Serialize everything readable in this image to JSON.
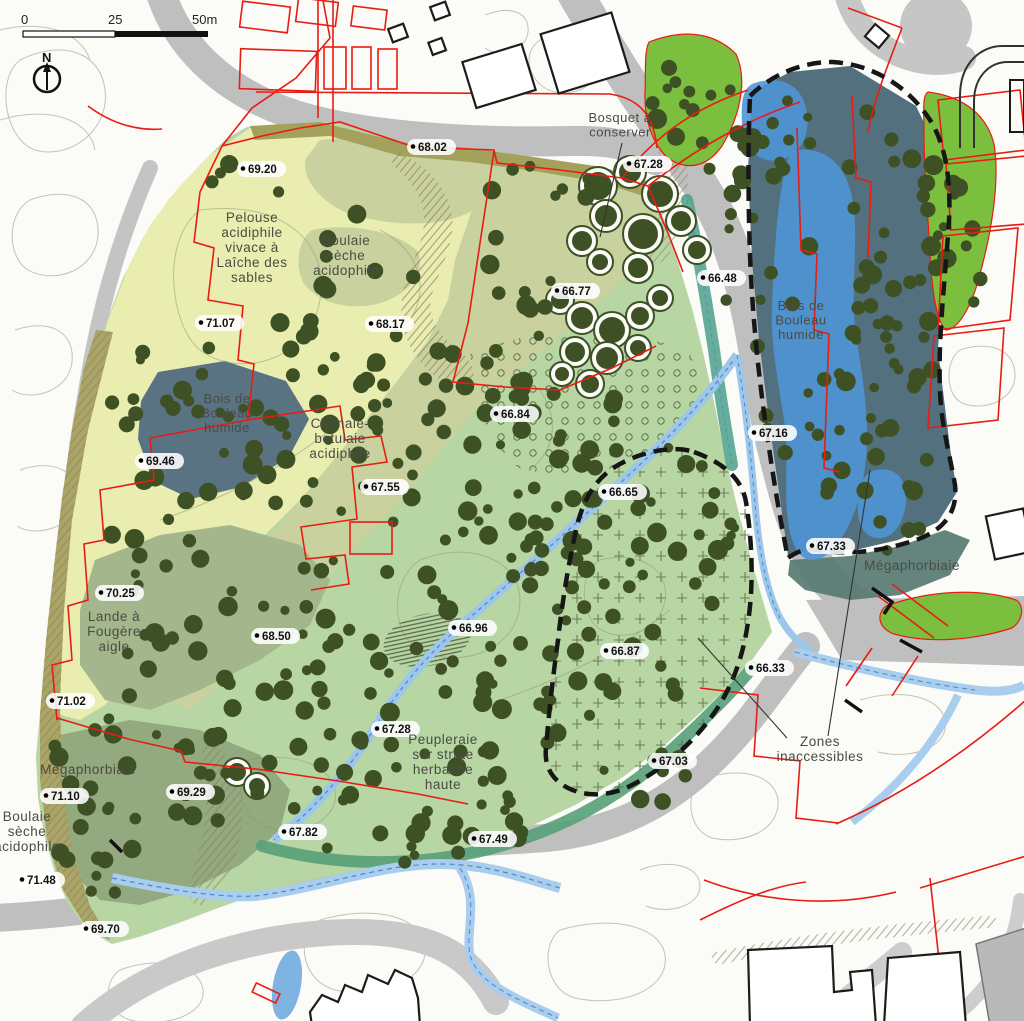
{
  "map": {
    "scale_bar": {
      "tick_0": "0",
      "tick_25": "25",
      "tick_50": "50m"
    },
    "north_arrow": {
      "label": "N"
    },
    "zone_labels": [
      {
        "name": "pelouse-acidiphile",
        "lines": [
          "Pelouse",
          "acidiphile",
          "vivace à",
          "Laîche des",
          "sables"
        ],
        "x": 252,
        "y": 222,
        "size": 13.5
      },
      {
        "name": "boulaie-seche-nord",
        "lines": [
          "Boulaie",
          "sèche",
          "acidophile"
        ],
        "x": 346,
        "y": 245,
        "size": 13.5
      },
      {
        "name": "chenaie-betulaie",
        "lines": [
          "Chênaie-",
          "betulaie",
          "acidiphile"
        ],
        "x": 340,
        "y": 428,
        "size": 13.5
      },
      {
        "name": "bois-bouleau-humide-ouest",
        "lines": [
          "Bois de",
          "Bouleau",
          "humide"
        ],
        "x": 227,
        "y": 403,
        "size": 13
      },
      {
        "name": "bois-bouleau-humide-est",
        "lines": [
          "Bois de",
          "Bouleau",
          "humide"
        ],
        "x": 801,
        "y": 310,
        "size": 13
      },
      {
        "name": "lande-fougere-aigle",
        "lines": [
          "Lande à",
          "Fougère",
          "aigle"
        ],
        "x": 114,
        "y": 621,
        "size": 13.5
      },
      {
        "name": "megaphorbiaie-sud-ouest",
        "lines": [
          "Mégaphorbiaie"
        ],
        "x": 88,
        "y": 774,
        "size": 13.5
      },
      {
        "name": "boulaie-seche-sud-ouest",
        "lines": [
          "Boulaie",
          "sèche",
          "acidophile"
        ],
        "x": 27,
        "y": 821,
        "size": 13.5
      },
      {
        "name": "megaphorbiaie-est",
        "lines": [
          "Mégaphorbiaie"
        ],
        "x": 912,
        "y": 570,
        "size": 13.5
      },
      {
        "name": "peupleraie",
        "lines": [
          "Peupleraie",
          "sur strate",
          "herbacée",
          "haute"
        ],
        "x": 443,
        "y": 744,
        "size": 13.5
      },
      {
        "name": "bosquet-a-conserver",
        "lines": [
          "Bosquet à",
          "conserver"
        ],
        "x": 620,
        "y": 122,
        "size": 13
      },
      {
        "name": "zones-inaccessibles",
        "lines": [
          "Zones",
          "inaccessibles"
        ],
        "x": 820,
        "y": 746,
        "size": 13.5
      }
    ],
    "elevation_points": [
      {
        "v": "69.20",
        "x": 243,
        "y": 172
      },
      {
        "v": "68.02",
        "x": 413,
        "y": 150
      },
      {
        "v": "67.28",
        "x": 629,
        "y": 167
      },
      {
        "v": "66.77",
        "x": 557,
        "y": 294
      },
      {
        "v": "66.48",
        "x": 703,
        "y": 281
      },
      {
        "v": "71.07",
        "x": 201,
        "y": 326
      },
      {
        "v": "68.17",
        "x": 371,
        "y": 327
      },
      {
        "v": "66.84",
        "x": 496,
        "y": 417
      },
      {
        "v": "67.16",
        "x": 754,
        "y": 436
      },
      {
        "v": "69.46",
        "x": 141,
        "y": 464
      },
      {
        "v": "67.55",
        "x": 366,
        "y": 490
      },
      {
        "v": "66.65",
        "x": 604,
        "y": 495
      },
      {
        "v": "67.33",
        "x": 812,
        "y": 549
      },
      {
        "v": "70.25",
        "x": 101,
        "y": 596
      },
      {
        "v": "68.50",
        "x": 257,
        "y": 639
      },
      {
        "v": "66.96",
        "x": 454,
        "y": 631
      },
      {
        "v": "66.87",
        "x": 606,
        "y": 654
      },
      {
        "v": "66.33",
        "x": 751,
        "y": 671
      },
      {
        "v": "71.02",
        "x": 52,
        "y": 704
      },
      {
        "v": "67.28",
        "x": 377,
        "y": 732
      },
      {
        "v": "67.03",
        "x": 654,
        "y": 764
      },
      {
        "v": "71.10",
        "x": 46,
        "y": 799
      },
      {
        "v": "69.29",
        "x": 172,
        "y": 795
      },
      {
        "v": "67.82",
        "x": 284,
        "y": 835
      },
      {
        "v": "67.49",
        "x": 474,
        "y": 842
      },
      {
        "v": "71.48",
        "x": 22,
        "y": 883
      },
      {
        "v": "69.70",
        "x": 86,
        "y": 932
      }
    ],
    "colors": {
      "park_green": "#b7d6a4",
      "pale_meadow": "#e9edb0",
      "woodland_sage": "#c9d29f",
      "lande_green": "#a4b68b",
      "wet_wood_slate": "#587381",
      "water_blue": "#4f95d5",
      "meadow_bright": "#7cbe3d",
      "cadastral_red": "#e81c13",
      "tree_green": "#3d5124",
      "stream_blue": "#9cc6ea",
      "road_gray": "#bfbfbf"
    }
  }
}
